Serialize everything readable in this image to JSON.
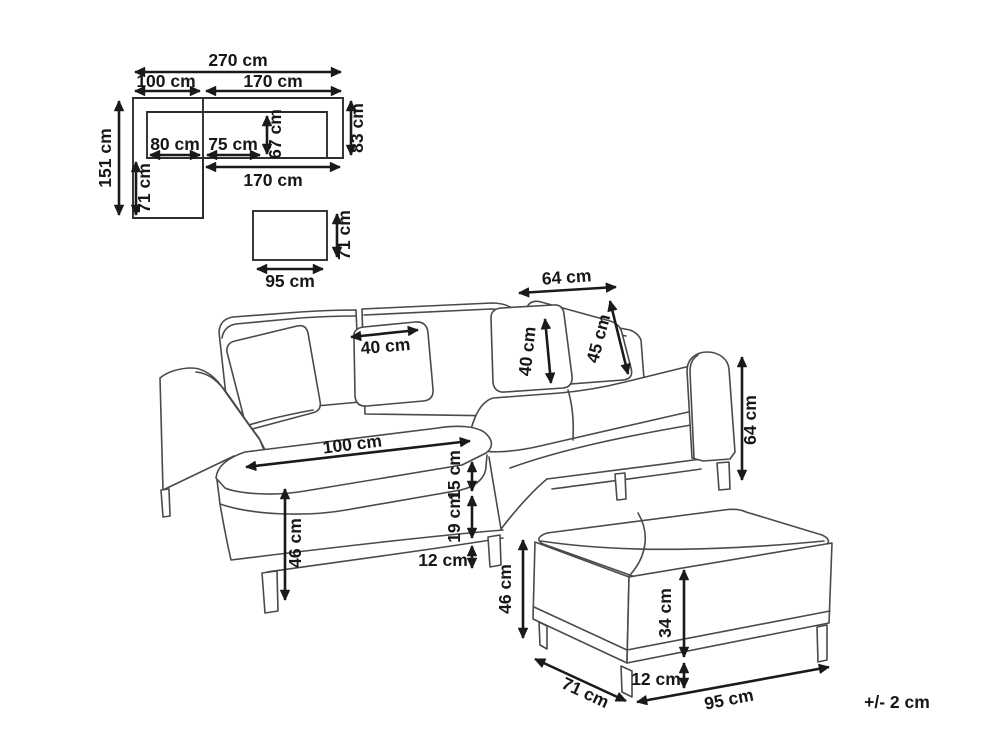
{
  "plan": {
    "total_width": "270 cm",
    "chaise_width": "100 cm",
    "section_width": "170 cm",
    "total_depth": "151 cm",
    "section_depth": "83 cm",
    "seat_depth": "67 cm",
    "chaise_seat_width": "80 cm",
    "seat_width": "75 cm",
    "inner_width": "170 cm",
    "chaise_extension": "71 cm",
    "ottoman_width": "95 cm",
    "ottoman_depth": "71 cm"
  },
  "sofa": {
    "pillow_width": "40 cm",
    "back_cushion_width": "64 cm",
    "back_cushion_height": "40 cm",
    "corner_cushion_height": "45 cm",
    "back_height": "64 cm",
    "chaise_length": "100 cm",
    "seat_thickness": "15 cm",
    "base_height": "19 cm",
    "leg_height": "12 cm",
    "seat_height": "46 cm"
  },
  "ottoman": {
    "height": "46 cm",
    "depth": "71 cm",
    "body_height": "34 cm",
    "leg_height": "12 cm",
    "width": "95 cm"
  },
  "note": {
    "tolerance": "+/- 2 cm"
  }
}
